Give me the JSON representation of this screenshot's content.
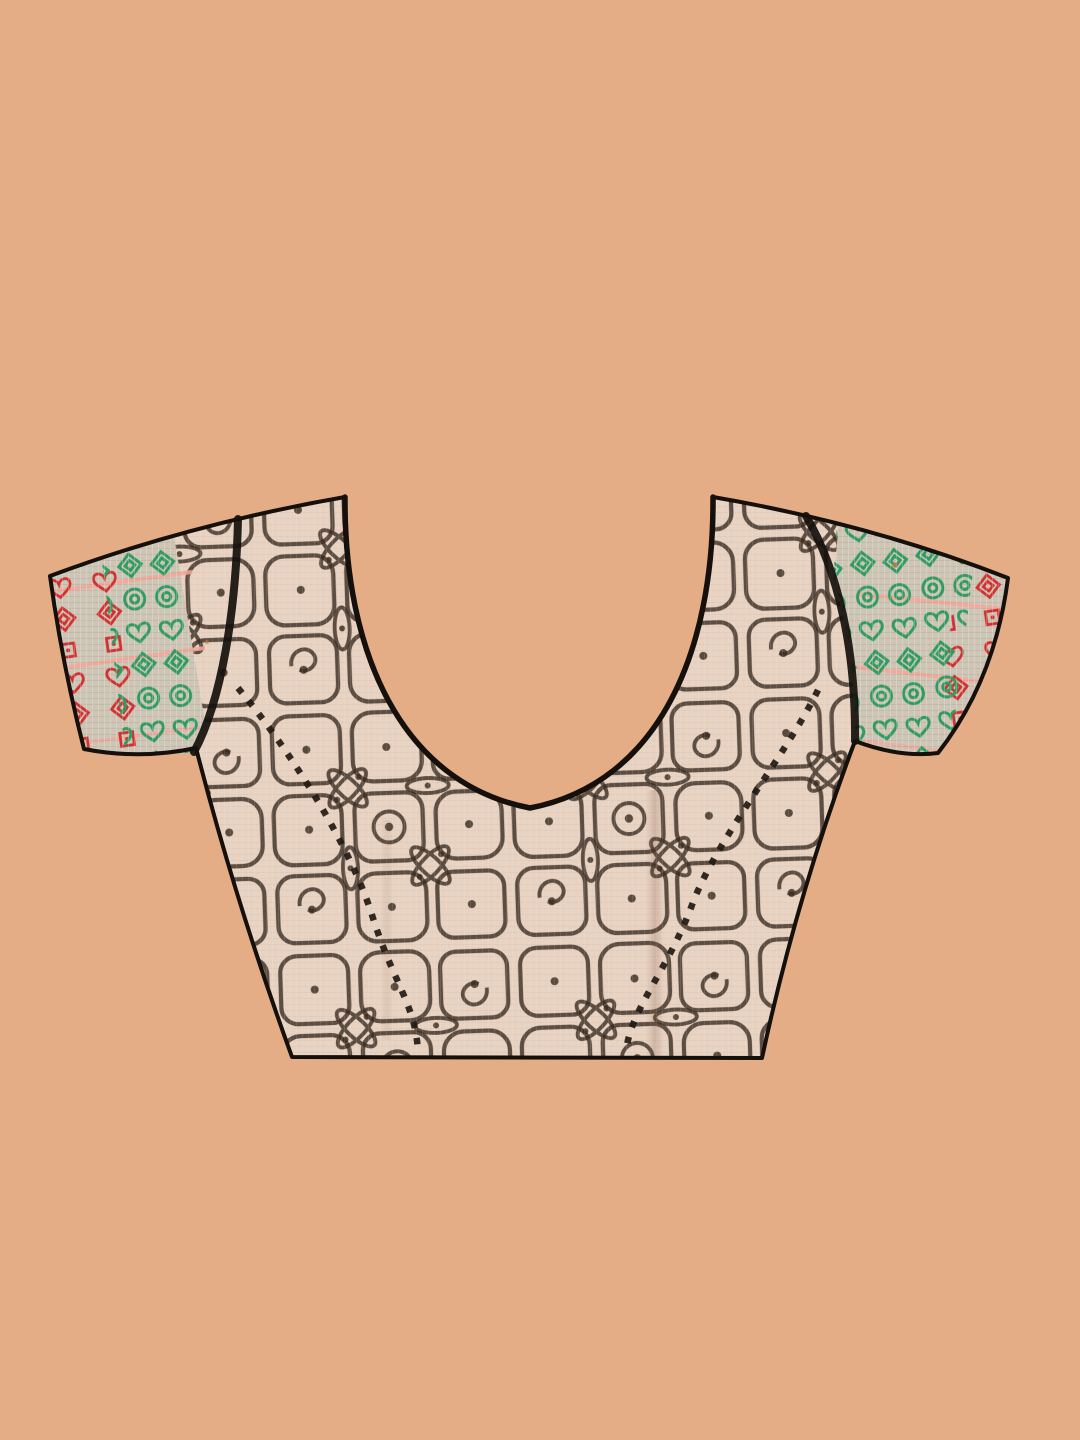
{
  "image": {
    "alt": "Back view of a beige saree blouse with black kolam block print, deep round neckline, dotted princess seams and green-red woven sleeve borders on a peach backdrop"
  },
  "colors": {
    "backdrop": "#e4ad85",
    "fabric": "#e8d2c1",
    "print": "#392b21",
    "outline": "#15100c",
    "seam": "#211a14",
    "borderGround": "#cdc5b6",
    "borderGreen": "#2e9c62",
    "borderRed": "#d22f2f",
    "borderPink": "#f2a69b",
    "speck": "#c07a42"
  }
}
